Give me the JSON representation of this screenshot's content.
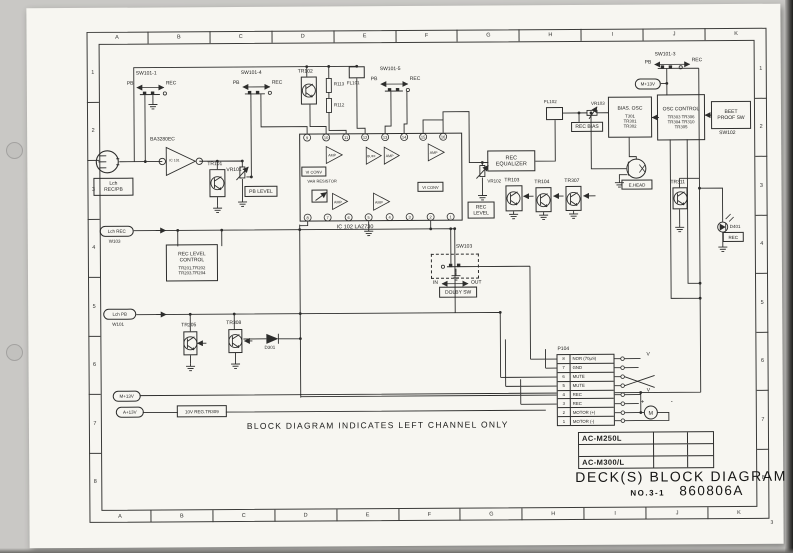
{
  "frame": {
    "letters": [
      "A",
      "B",
      "C",
      "D",
      "E",
      "F",
      "G",
      "H",
      "I",
      "J",
      "K"
    ],
    "numbers": [
      "1",
      "2",
      "3",
      "4",
      "5",
      "6",
      "7",
      "8"
    ],
    "page_no": "3"
  },
  "note": "BLOCK DIAGRAM INDICATES LEFT CHANNEL ONLY",
  "title_block": {
    "model_1": "AC-M250L",
    "model_2": "",
    "model_3": "AC-M300/L",
    "title": "DECK(S) BLOCK  DIAGRAM",
    "no_label": "NO.3-1",
    "doc_no": "860806A"
  },
  "connector": {
    "name": "P104",
    "pins": [
      {
        "no": "8",
        "label": "NOR (70µS)"
      },
      {
        "no": "7",
        "label": "GND"
      },
      {
        "no": "6",
        "label": "MUTE"
      },
      {
        "no": "5",
        "label": "MUTE"
      },
      {
        "no": "4",
        "label": "REC"
      },
      {
        "no": "3",
        "label": "REC"
      },
      {
        "no": "2",
        "label": "MOTOR (+)"
      },
      {
        "no": "1",
        "label": "MOTOR (-)"
      }
    ],
    "motor": "M",
    "plus": "+",
    "minus": "-",
    "v_mark": "V"
  },
  "ic102_pins": {
    "top": [
      "9",
      "10",
      "11",
      "12",
      "13",
      "14",
      "15",
      "16"
    ],
    "bottom": [
      "8",
      "7",
      "6",
      "5",
      "4",
      "3",
      "2",
      "1"
    ]
  },
  "labels": {
    "sw101_1": "SW101-1",
    "sw101_3": "SW101-3",
    "sw101_4": "SW101-4",
    "sw101_5": "SW101-5",
    "pb": "PB",
    "rec": "REC",
    "in": "IN",
    "out": "OUT",
    "sw102": "SW102",
    "sw103": "SW103",
    "tr101": "TR101",
    "tr102": "TR102",
    "tr103": "TR103",
    "tr104": "TR104",
    "tr307": "TR307",
    "tr311": "TR311",
    "tr205": "TR205",
    "tr308": "TR308",
    "vr101": "VR101",
    "vr102": "VR102",
    "vr103": "VR103",
    "r112": "R112",
    "r113": "R113",
    "fl101": "FL101",
    "fl102": "FL102",
    "d301": "D301",
    "d401": "D401",
    "ic101_part": "BA3280EC",
    "ic101": "IC 101",
    "ic102": "IC 102   LA2730",
    "amp": "AMP",
    "buff": "BUFF",
    "vi_conv": "VI CONV",
    "var_resistor": "VAR RESISTOR",
    "pb_level": "PB LEVEL",
    "rec_bias": "REC BIAS",
    "rec_led": "REC",
    "e_head": "E.HEAD",
    "dolby_sw": "DOLBY SW",
    "m13v": "M+13V",
    "a13v": "A+13V",
    "reg": "10V REG.TR309",
    "lch_rec": "Lch REC",
    "w103": "W103",
    "lch_pb": "Lch PB",
    "w101": "W101",
    "jack1": "Lch",
    "jack2": "REC/PB"
  },
  "blocks": {
    "bias_osc": {
      "title": "BIAS. OSC",
      "p1": "T301",
      "p2": "TR301",
      "p3": "TR302"
    },
    "osc_control": {
      "title": "OSC CONTROL",
      "r1": "TR303  TR306",
      "r2": "TR304  TR310",
      "r3": "TR305"
    },
    "beet_proof": {
      "l1": "BEET",
      "l2": "PROOF  SW"
    },
    "rec_eq": {
      "l1": "REC",
      "l2": "EQUALIZER"
    },
    "rec_level": {
      "l1": "REC",
      "l2": "LEVEL"
    },
    "rec_level_control": {
      "l1": "REC  LEVEL",
      "l2": "CONTROL",
      "l3": "TR201,TR202",
      "l4": "TR203,TR204"
    }
  }
}
